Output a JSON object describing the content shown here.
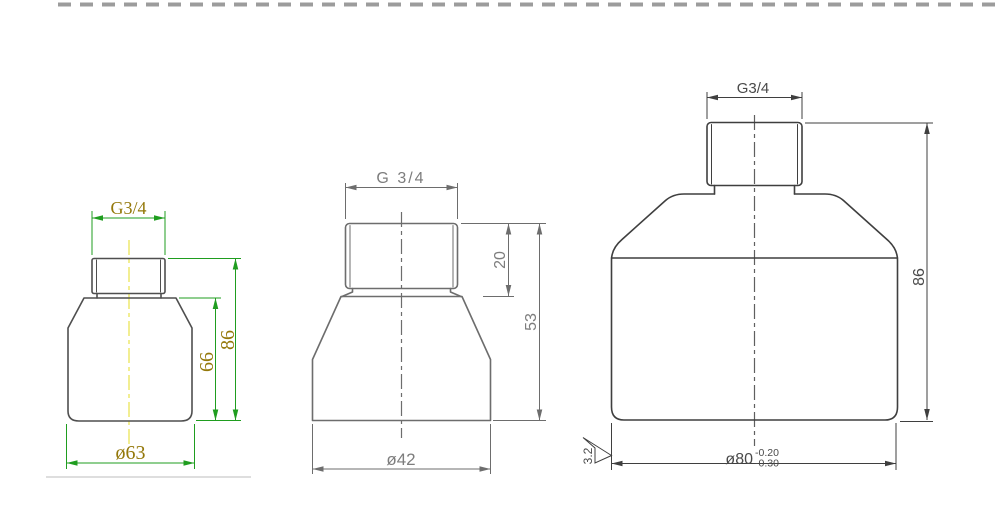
{
  "page": {
    "background_color": "#ffffff",
    "top_border": {
      "style": "dashed",
      "color": "#9c9c9c"
    },
    "artifact_line_color": "#dedede"
  },
  "views": {
    "left": {
      "thread_label": "G3/4",
      "dims": {
        "body_height": "66",
        "total_height": "86",
        "outer_diameter": "ø63"
      },
      "colors": {
        "outline": "#4f4f4f",
        "dimension_lines": "#1f9d1f",
        "dimension_text": "#94780a",
        "centerline": "#e8e24a"
      }
    },
    "middle": {
      "thread_label": "G 3/4",
      "dims": {
        "thread_height": "20",
        "total_height": "53",
        "outer_diameter": "ø42"
      },
      "colors": {
        "outline": "#6d6d6d",
        "dimension_lines": "#6d6d6d",
        "dimension_text": "#7d7d7d",
        "centerline": "#6d6d6d"
      }
    },
    "right": {
      "thread_label": "G3/4",
      "dims": {
        "total_height": "86",
        "outer_diameter": "ø80",
        "diameter_tolerance_upper": "-0.20",
        "diameter_tolerance_lower": "-0.30",
        "surface_roughness": "3.2"
      },
      "colors": {
        "outline": "#3f3f3f",
        "dimension_lines": "#3f3f3f",
        "dimension_text": "#4a4a4a",
        "centerline": "#5f5f5f"
      }
    }
  }
}
